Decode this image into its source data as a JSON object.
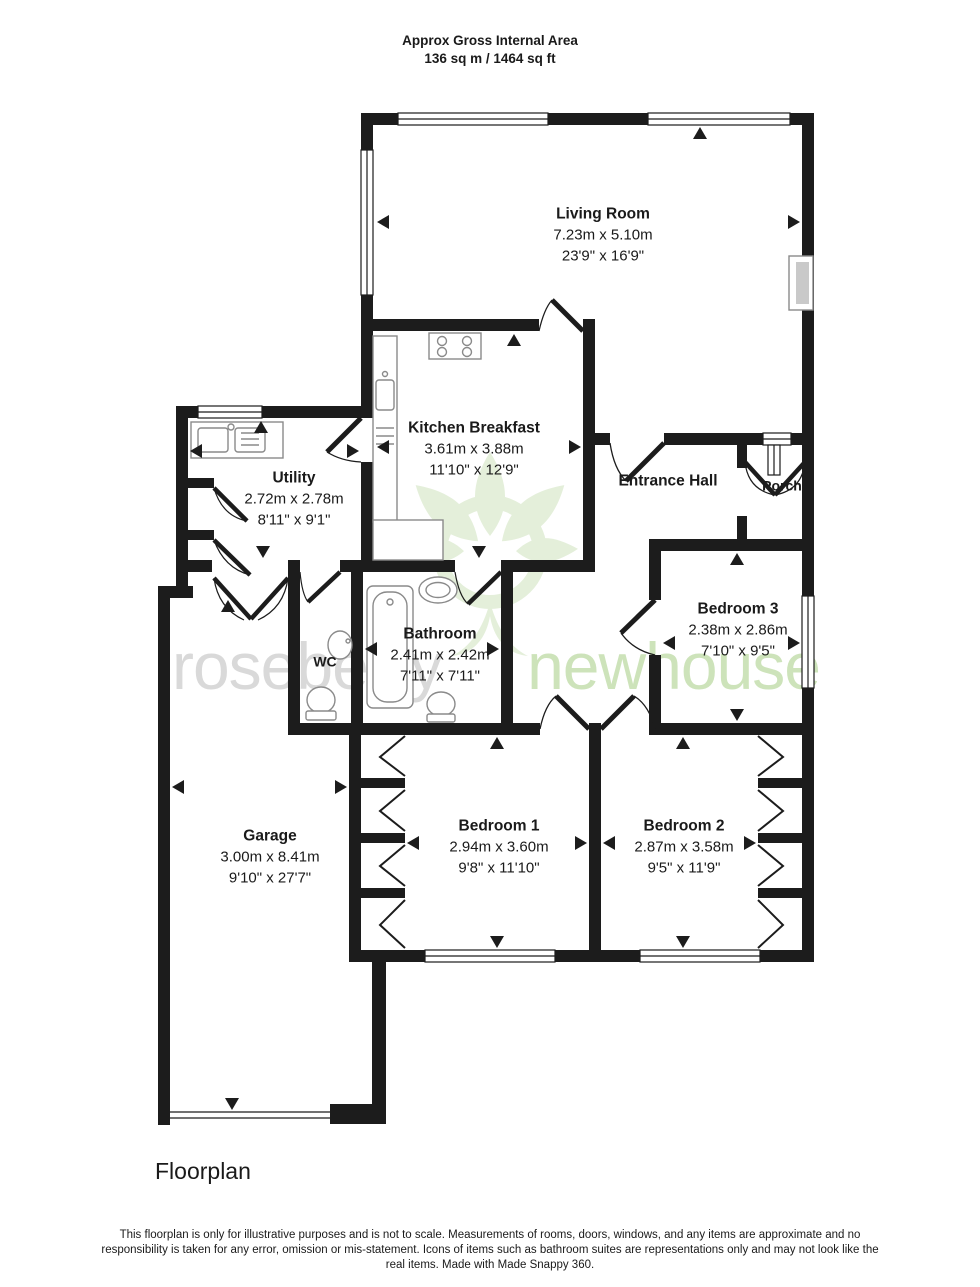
{
  "header": {
    "line1": "Approx Gross Internal Area",
    "line2": "136 sq m / 1464 sq ft"
  },
  "rooms": [
    {
      "name": "Living Room",
      "metric": "7.23m x 5.10m",
      "imperial": "23'9\" x 16'9\""
    },
    {
      "name": "Kitchen Breakfast",
      "metric": "3.61m x 3.88m",
      "imperial": "11'10\" x 12'9\""
    },
    {
      "name": "Utility",
      "metric": "2.72m x 2.78m",
      "imperial": "8'11\" x 9'1\""
    },
    {
      "name": "Entrance Hall"
    },
    {
      "name": "Porch"
    },
    {
      "name": "Bedroom 3",
      "metric": "2.38m x 2.86m",
      "imperial": "7'10\" x 9'5\""
    },
    {
      "name": "Bathroom",
      "metric": "2.41m x 2.42m",
      "imperial": "7'11\" x 7'11\""
    },
    {
      "name": "WC"
    },
    {
      "name": "Bedroom 1",
      "metric": "2.94m x 3.60m",
      "imperial": "9'8\" x 11'10\""
    },
    {
      "name": "Bedroom 2",
      "metric": "2.87m x 3.58m",
      "imperial": "9'5\" x 11'9\""
    },
    {
      "name": "Garage",
      "metric": "3.00m x 8.41m",
      "imperial": "9'10\" x 27'7\""
    }
  ],
  "watermark": {
    "word1": "roseberry",
    "word2": "newhouse"
  },
  "footer": {
    "caption": "Floorplan",
    "disclaimer": "This floorplan is only for illustrative purposes and is not to scale. Measurements of rooms, doors, windows, and any items are approximate and no responsibility is taken for any error, omission or mis-statement. Icons of items such as bathroom suites are representations only and may not look like the real items. Made with Made Snappy 360."
  },
  "colors": {
    "wall": "#1c1c1c",
    "fixture": "#8a8a8a",
    "watermark_gray": "#d9d9d9",
    "watermark_green": "#cde3ba",
    "logo_green": "#e4efda"
  }
}
